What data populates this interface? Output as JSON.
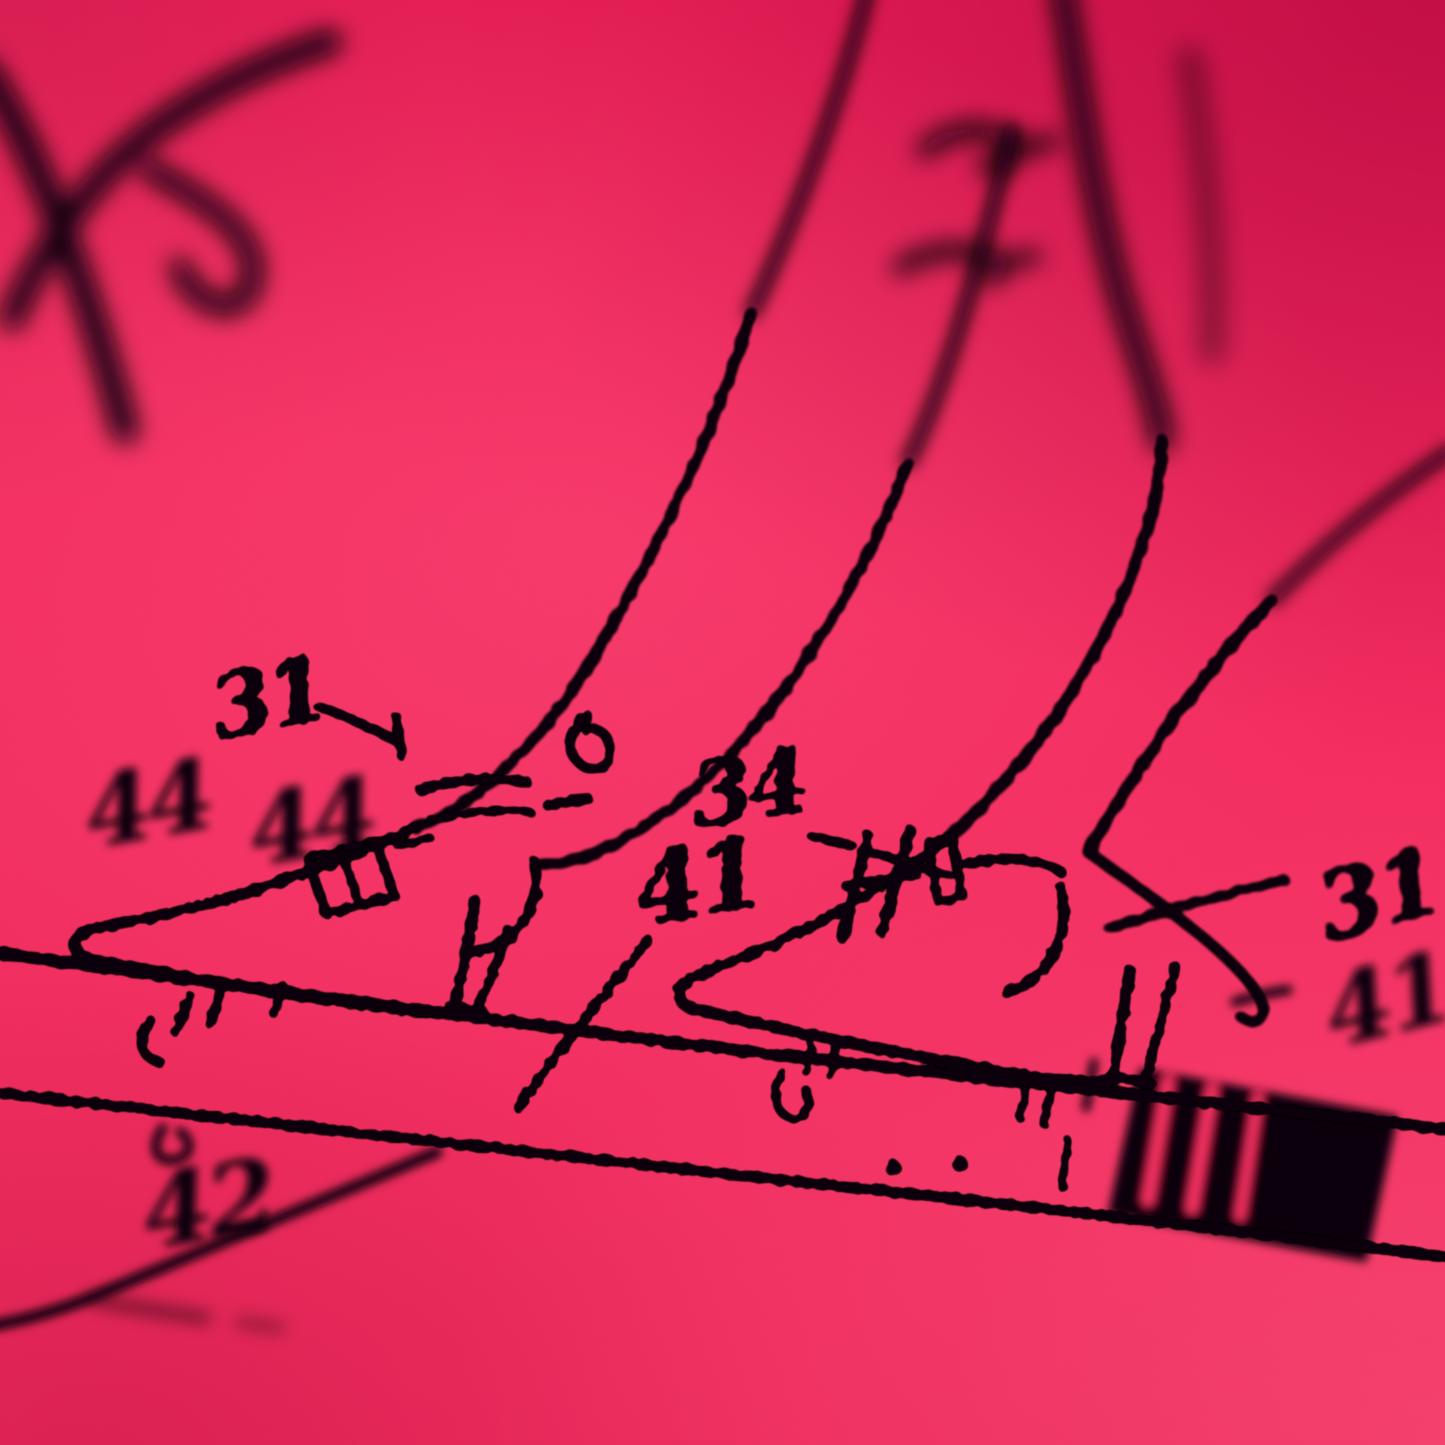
{
  "image": {
    "title": "Macro photograph of a black-ink patent-style drawing printed on vivid pink paper",
    "subject": "Two stocking-clad legs wearing ankle-strap high-heel shoes standing on a weighing-scale platform, with numbered reference labels and leader lines",
    "style": "halftone screen print, shallow depth of field, oblique camera angle; top and lower-left of frame are out of focus"
  },
  "colors": {
    "paper_center": "#f93062",
    "paper_highlight": "#ff5c87",
    "paper_top_right": "#e9185a",
    "paper_bottom_right": "#fb4a72",
    "paper_bottom_edge": "#e01b4e",
    "ink": "#070107"
  },
  "reference_labels": [
    {
      "id": "31-left",
      "text": "31",
      "x": 268,
      "y": 700,
      "size": 88,
      "rotate": -12,
      "focus": "sharp"
    },
    {
      "id": "44-a",
      "text": "44",
      "x": 148,
      "y": 806,
      "size": 96,
      "rotate": -10,
      "focus": "soft"
    },
    {
      "id": "44-b",
      "text": "44",
      "x": 312,
      "y": 824,
      "size": 96,
      "rotate": -10,
      "focus": "soft"
    },
    {
      "id": "34",
      "text": "34",
      "x": 748,
      "y": 790,
      "size": 88,
      "rotate": -9,
      "focus": "sharp"
    },
    {
      "id": "41-left",
      "text": "41",
      "x": 698,
      "y": 884,
      "size": 96,
      "rotate": -10,
      "focus": "sharp"
    },
    {
      "id": "42",
      "text": "42",
      "x": 208,
      "y": 1206,
      "size": 100,
      "rotate": -9,
      "focus": "soft"
    },
    {
      "id": "31-right",
      "text": "31",
      "x": 1378,
      "y": 896,
      "size": 92,
      "rotate": -15,
      "focus": "mid"
    },
    {
      "id": "41-right",
      "text": "41",
      "x": 1388,
      "y": 1002,
      "size": 96,
      "rotate": -14,
      "focus": "soft"
    }
  ],
  "illegible_marks": "additional blurred reference numerals near the top edge of the frame (out of focus)"
}
